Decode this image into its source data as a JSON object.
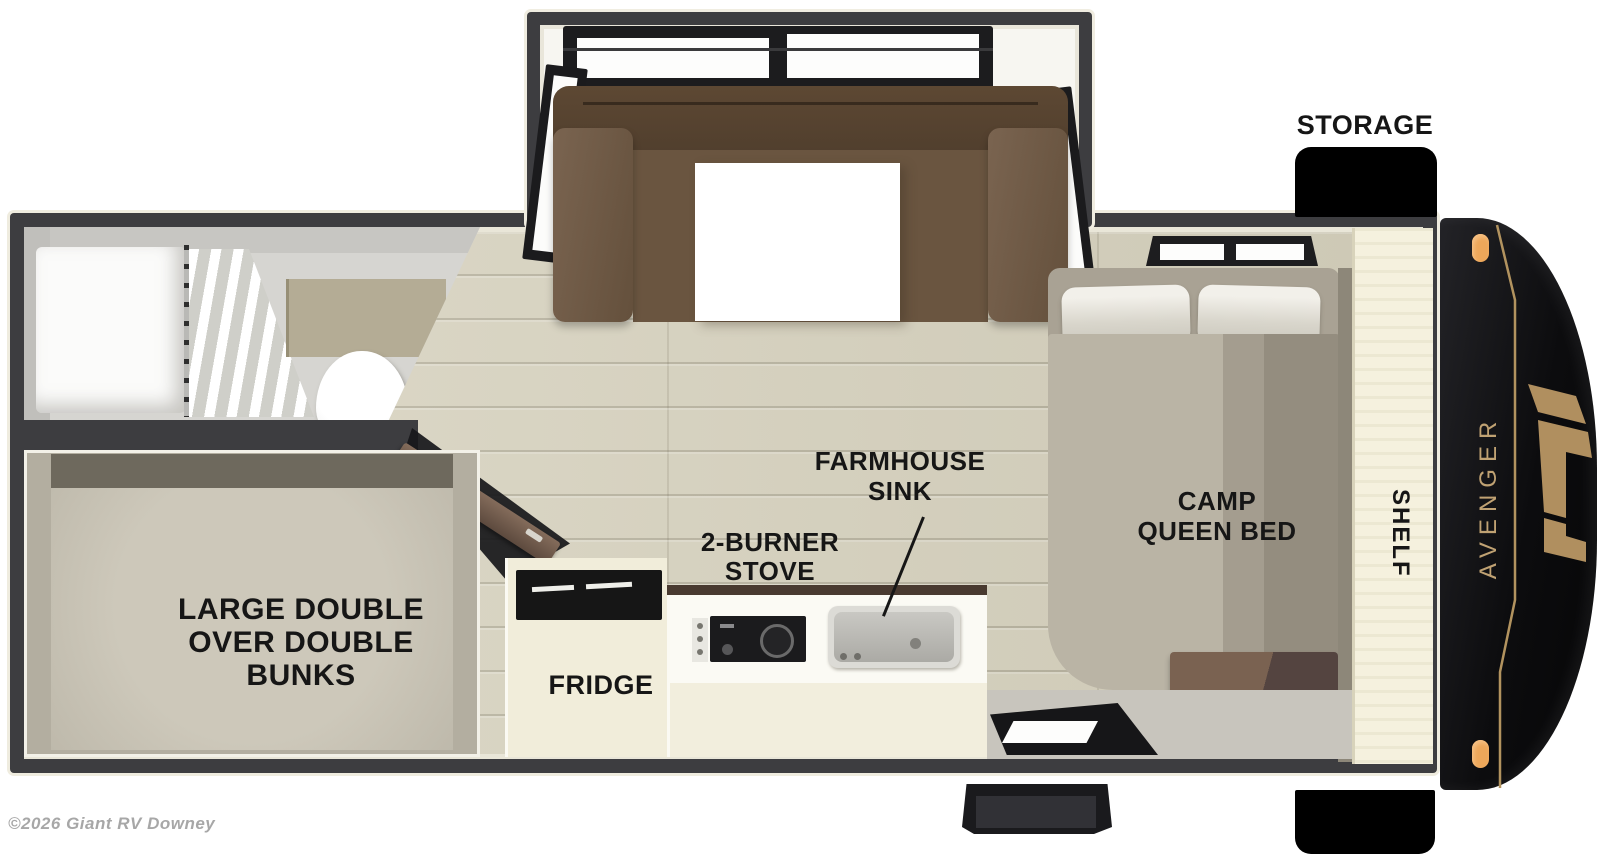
{
  "title": "Travel trailer floor plan",
  "brand_decal": "AVENGER",
  "watermark": "©2026 Giant RV Downey",
  "labels": {
    "storage": "STORAGE",
    "shelf": "SHELF",
    "fridge": "FRIDGE",
    "bed_lines": [
      "CAMP",
      "QUEEN BED"
    ],
    "sink_lines": [
      "FARMHOUSE",
      "SINK"
    ],
    "stove_lines": [
      "2-BURNER",
      "STOVE"
    ],
    "bunk_lines": [
      "LARGE DOUBLE",
      "OVER DOUBLE",
      "BUNKS"
    ]
  },
  "colors": {
    "wall": "#3d3d40",
    "floor_wood": "#d8d3bf",
    "cap_black": "#0c0c0e",
    "accent_gold": "#b89a6a",
    "marker_light": "#eda75a",
    "sofa_brown": "#5d4833",
    "label_text": "#161616"
  }
}
